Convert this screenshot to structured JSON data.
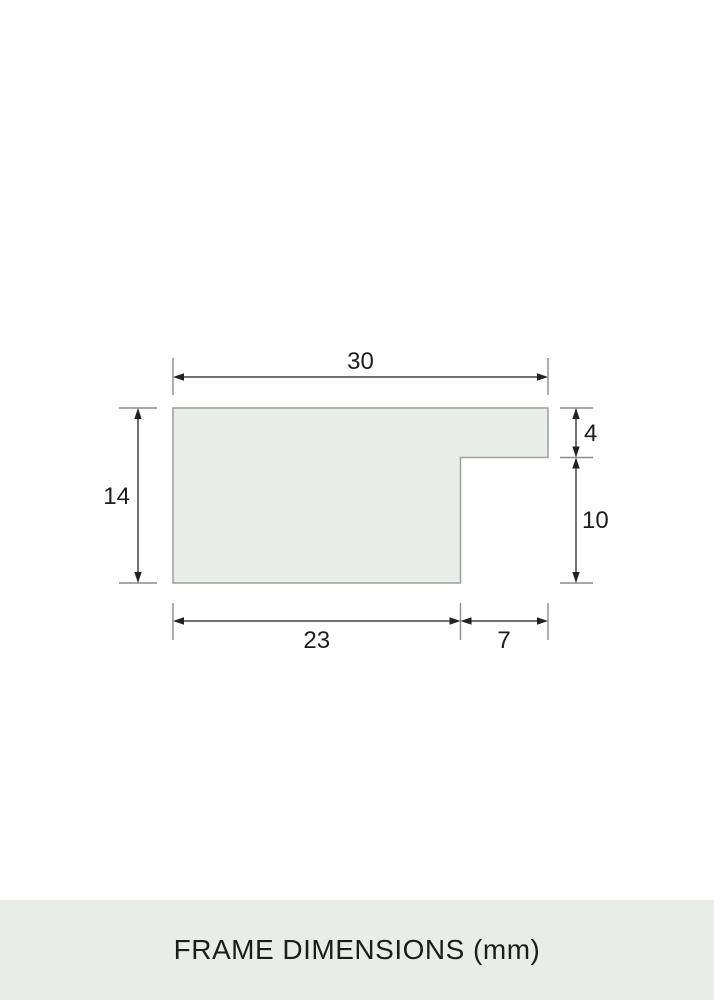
{
  "title": "FRAME DIMENSIONS (mm)",
  "dimensions": {
    "top_width": "30",
    "left_height": "14",
    "right_upper": "4",
    "right_lower": "10",
    "bottom_left": "23",
    "bottom_right": "7"
  },
  "colors": {
    "shape_fill": "#e9ede9",
    "shape_border": "#9aa09b",
    "extension_line": "#8c8c8c",
    "dimension_line": "#222222",
    "footer_background": "#e8ede9",
    "text_color": "#1d1d1d"
  }
}
